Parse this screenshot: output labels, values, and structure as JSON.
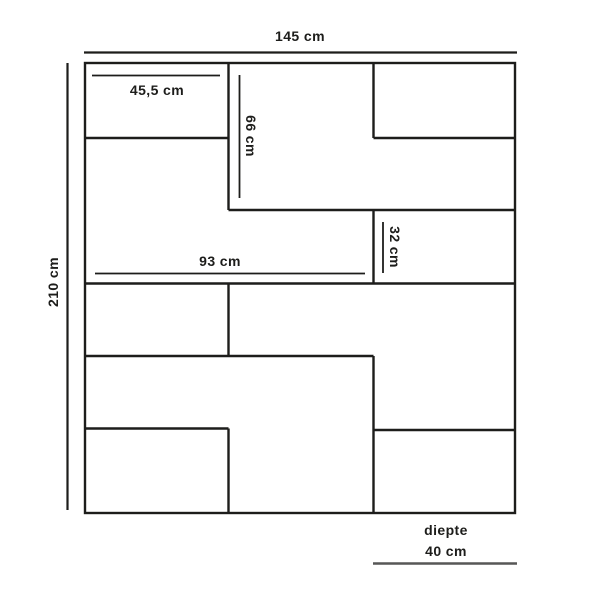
{
  "diagram": {
    "type": "furniture-dimension-diagram",
    "unit": "cm",
    "labels": {
      "total_width": "145 cm",
      "total_height": "210 cm",
      "top_left_shelf_width": "45,5 cm",
      "middle_compartment_height": "66 cm",
      "middle_shelf_width": "93 cm",
      "right_shelf_height": "32 cm",
      "depth_caption": "diepte",
      "depth_value": "40 cm"
    },
    "dimensions": [
      {
        "name": "total width",
        "value": "145 cm",
        "orientation": "horizontal"
      },
      {
        "name": "total height",
        "value": "210 cm",
        "orientation": "vertical"
      },
      {
        "name": "top left shelf width",
        "value": "45,5 cm",
        "orientation": "horizontal"
      },
      {
        "name": "middle compartment height",
        "value": "66 cm",
        "orientation": "vertical"
      },
      {
        "name": "middle shelf width",
        "value": "93 cm",
        "orientation": "horizontal"
      },
      {
        "name": "right shelf height",
        "value": "32 cm",
        "orientation": "vertical"
      },
      {
        "name": "depth",
        "value": "40 cm",
        "orientation": "horizontal"
      }
    ],
    "colors": {
      "line": "#1d1d1b",
      "dimension_line": "#1d1d1b",
      "depth_underline": "#575756",
      "text": "#1d1d1b",
      "background": "#ffffff"
    }
  }
}
